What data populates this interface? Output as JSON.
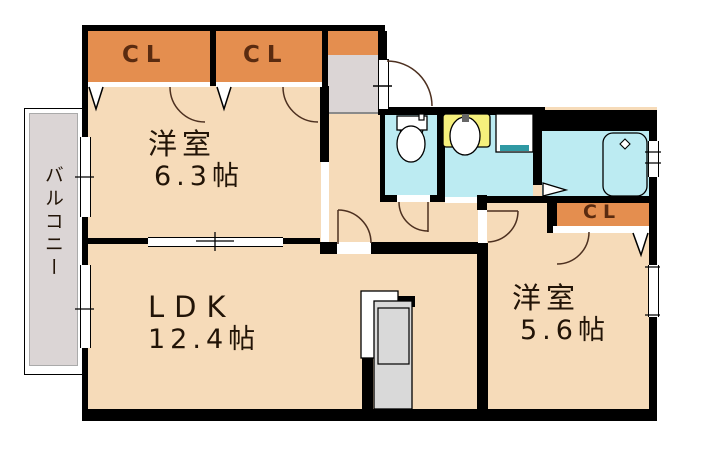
{
  "title": "apartment floor plan",
  "palette": {
    "wall": "#000000",
    "room": "#F6DBB9",
    "closet": "#E48E4F",
    "balcony": "#DBD5D5",
    "water": "#BCEBF2",
    "fixture_yellow": "#F6F07C",
    "teal": "#2F99A3",
    "counter": "#D9D9D9",
    "arc": "#4d3020",
    "text": "#221407"
  },
  "rooms": {
    "room1": {
      "name": "洋室",
      "size": "6.3帖"
    },
    "ldk": {
      "name": "LDK",
      "size": "12.4帖"
    },
    "room2": {
      "name": "洋室",
      "size": "5.6帖"
    },
    "balcony": {
      "name": "バルコニー"
    },
    "closet1": {
      "label": "CL"
    },
    "closet2": {
      "label": "CL"
    },
    "closet3": {
      "label": "CL"
    }
  },
  "fixtures": {
    "toilet": "toilet",
    "vanity": "wash-basin",
    "washer_pan": "washing-machine-pan",
    "bathtub": "bathtub",
    "kitchen": "kitchen-counter",
    "shoe_cabinet": "shoe-cabinet",
    "entry": "entry-door"
  }
}
